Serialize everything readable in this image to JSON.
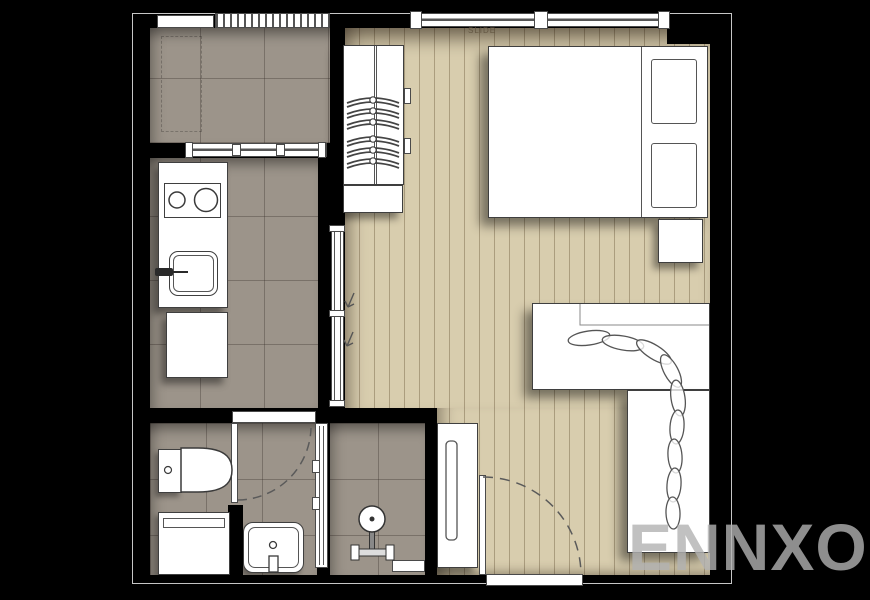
{
  "meta": {
    "type": "apartment-floor-plan"
  },
  "watermark": {
    "text": "ENNXO"
  },
  "annotations": {
    "window_label": "SLIDE"
  },
  "palette": {
    "background": "#000000",
    "plan_edge": "#c6c6c6",
    "wood_floor": "#d8cdae",
    "tile_floor": "#9c948a",
    "fixture_fill": "#ffffff",
    "fixture_outline": "#3f3f3f"
  },
  "rooms": [
    "balcony",
    "kitchen",
    "living-bedroom",
    "bathroom",
    "shower",
    "entry"
  ],
  "fixtures": [
    "louver-window",
    "balcony-door",
    "sliding-windows",
    "pass-through-window",
    "wardrobe",
    "clothes-hangers",
    "double-bed",
    "pillows",
    "nightstand",
    "l-shaped-desk",
    "plant-garland",
    "kitchen-counter",
    "stove",
    "kitchen-sink",
    "refrigerator",
    "sliding-door",
    "bathroom-door",
    "toilet",
    "vanity",
    "wash-basin",
    "glass-partition",
    "shower-head",
    "entry-cabinet",
    "entrance-door"
  ]
}
